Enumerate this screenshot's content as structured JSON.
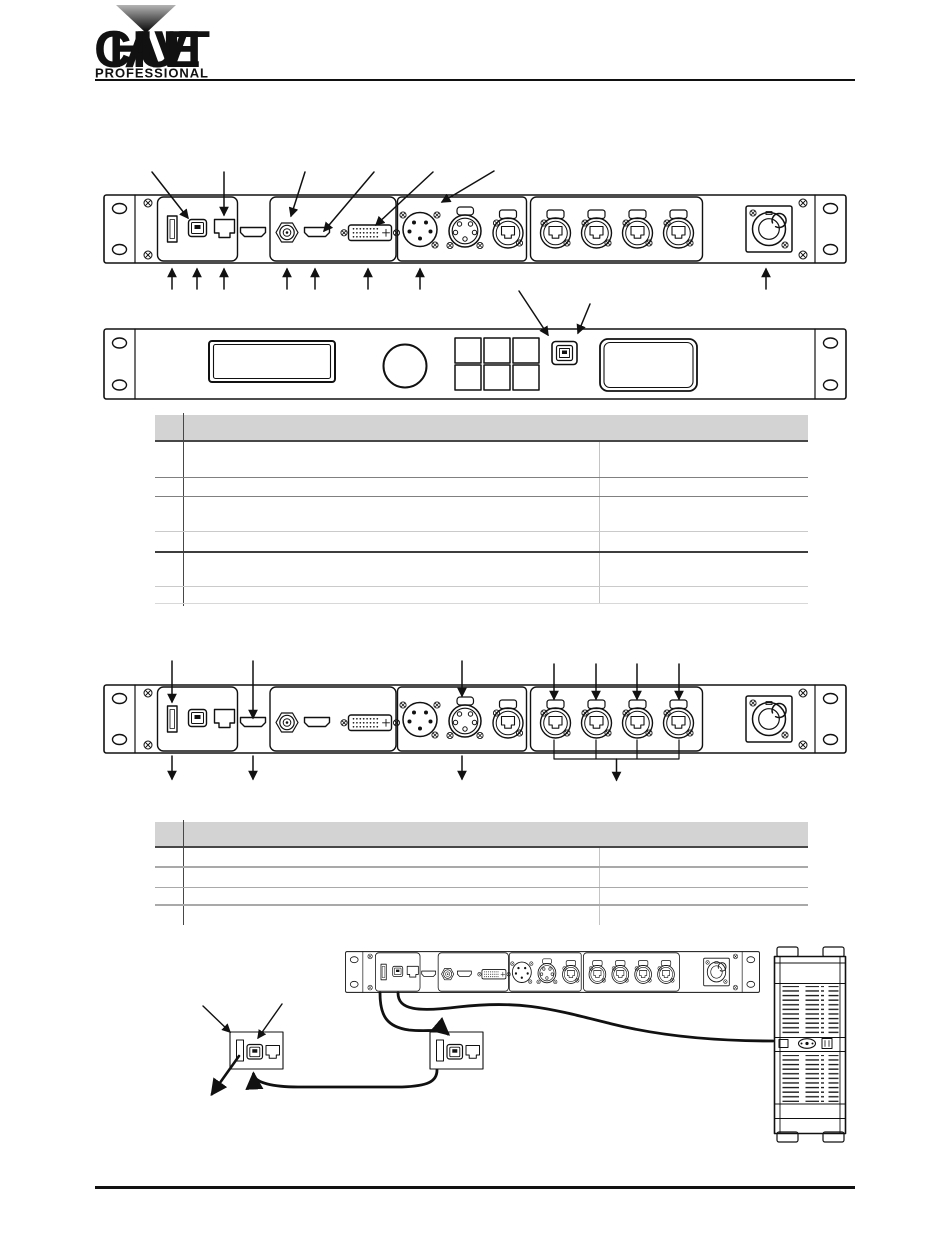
{
  "page": {
    "width": 950,
    "height": 1241,
    "kind": "product-manual-page"
  },
  "logo": {
    "brand": "CHAUVET",
    "sub": "PROFESSIONAL"
  },
  "colors": {
    "ink": "#111111",
    "table_header_fill": "#d3d3d3",
    "table_border_dark": "#474747",
    "table_border_mid": "#808080",
    "table_border_light": "#cacaca"
  },
  "tables": {
    "rear_panel_legend": {
      "columns": [
        "",
        "",
        ""
      ],
      "rows": [
        [
          "",
          "",
          ""
        ],
        [
          "",
          "",
          ""
        ],
        [
          "",
          "",
          ""
        ],
        [
          "",
          "",
          ""
        ],
        [
          "",
          "",
          ""
        ],
        [
          "",
          "",
          ""
        ]
      ]
    },
    "signal_legend": {
      "columns": [
        "",
        "",
        ""
      ],
      "rows": [
        [
          "",
          "",
          ""
        ],
        [
          "",
          "",
          ""
        ],
        [
          "",
          "",
          ""
        ],
        [
          "",
          "",
          ""
        ]
      ]
    }
  },
  "diagrams": {
    "rear_panel": {
      "connectors": [
        "usb-a-port",
        "usb-b-port",
        "ethernet-rj45-port",
        "hdmi-port",
        "bnc-connector",
        "hdmi-port",
        "dvi-port",
        "xlr-5pin-male",
        "xlr-5pin-female",
        "ethercon-port",
        "ethercon-group-of-4",
        "powercon-inlet"
      ]
    },
    "front_panel": {
      "elements": [
        "lcd-display",
        "rotary-knob",
        "button-grid-2x3",
        "usb-b-port",
        "cover-panel"
      ]
    },
    "connection_diagram": {
      "elements": [
        "rear-panel-mini",
        "usb-link-box-1",
        "usb-link-box-2",
        "computer-tower",
        "usb-cables"
      ]
    }
  }
}
